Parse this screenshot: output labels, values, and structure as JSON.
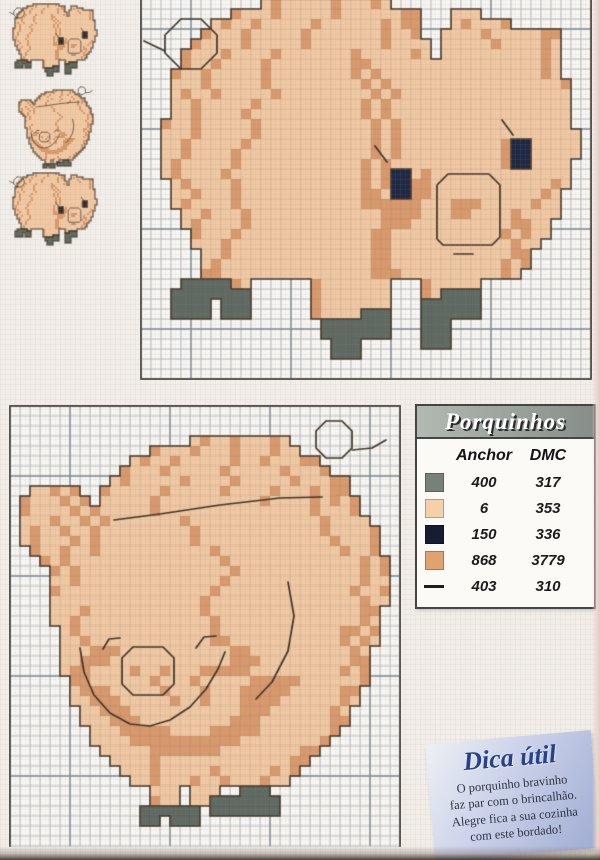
{
  "palette": {
    "l": "#f0c8a3",
    "d": "#d8996c",
    "g": "#5f6a62",
    "n": "#1f2945",
    "outline": "#46392c",
    "backstitch": "#3e342a",
    "grid_thin": "#b7c1c9",
    "grid_bold": "#8494a0",
    "grid_over": "rgba(90,80,70,0.16)",
    "cell_bg": "#f7f5f1",
    "border": "#56524c"
  },
  "legend": {
    "title": "Porquinhos",
    "columns": [
      "Anchor",
      "DMC"
    ],
    "rows": [
      {
        "symbol": "swatch",
        "color": "#76817a",
        "anchor": "400",
        "dmc": "317"
      },
      {
        "symbol": "swatch",
        "color": "#f6d0ab",
        "anchor": "6",
        "dmc": "353"
      },
      {
        "symbol": "swatch",
        "color": "#161d33",
        "anchor": "150",
        "dmc": "336"
      },
      {
        "symbol": "swatch",
        "color": "#e0a26f",
        "anchor": "868",
        "dmc": "3779"
      },
      {
        "symbol": "line",
        "color": "#1d1d1d",
        "anchor": "403",
        "dmc": "310"
      }
    ]
  },
  "tip_box": {
    "title": "Dica útil",
    "lines": [
      "O porquinho bravinho",
      "faz par com o brincalhão.",
      "Alegre fica a sua cozinha",
      "com este bordado!"
    ]
  },
  "charts": {
    "side_pig": {
      "cols": 45,
      "rows": 38,
      "bold_col_offset": 5,
      "bold_row_offset": 3,
      "borders": "LRB",
      "grid": [
        "............ldllllldllldl",
        ".........dllldllllldlllllldd...lll",
        ".......ldlldllllldlllllldldd...ldllld",
        "......dllldllllldllllllldlld..lllldllllldd",
        ".....dlllldllllldllllllldllll.llllldlllldl",
        "....dllldlllldllllllldllllldl.lllllllllldl",
        "....dlldlllldllllllllddllllllllllllllllldl",
        "...dlldllllldlllllllldldlllllllllllllllldl",
        "...llldllllldllllllllldldllllllllllllllllld",
        "...ldlldllllldllllllllldldlllllllllllllllll",
        "...lldllllldlllllllllldldllllllllllllllllll",
        "...lldlllldllllllllllldldllllllllllllllllll",
        "..dlldllllldllllllllllldldlllllllllllllllll",
        "..llldllllldllllllllllldldllllllllllllllllll",
        "..lldllllldlllllllllllldldlllllllllldnnlllll",
        "..lldlllldllllllllllllldldlllllllllldnnlllll",
        "..ldllllldlllllllllllldldllllllllllldnnllll",
        "..ldlllldllllllllllllldldnnldllllllllllllll",
        "...ldlllldlllllllllllldldnnddlllllllllllldl",
        "...lldllldllllllllllllddlnnddllllllllllldl",
        "...ldlllldllllllllllllddddddllldddllllldll",
        "....lldllldlllllllllllllddddlllddlllldllll",
        "....ldlllldllllllllllllldddllllllllllddll",
        ".....dllldlllllllllllllddllllllllllldldll",
        ".....llldllllllllllllllddlllllllllllldll",
        "......lldllllllllllllllddlllllllllllldd",
        "......ldlllllllllllllllddllllllllllldld",
        "......ddllllllllllllllldddlllllllllldl",
        "....gggggdl......dlllllll...dlllll",
        "...gggggggg......dlllllll...dlgggg",
        "...gggg.ggg......dlllllll...gggggg",
        "...gggg.ggg......dllllggg...gggggg",
        "..................ggggggg...ggg",
        "..................ggggggg...ggg",
        "...................ggg......ggg",
        "...................ggg",
        "",
        ""
      ],
      "backstitch": [
        [
          [
            4,
            2
          ],
          [
            6,
            2
          ],
          [
            7.6,
            3.6
          ],
          [
            7.6,
            5.4
          ],
          [
            6,
            7
          ],
          [
            4,
            7
          ],
          [
            2.4,
            5.4
          ],
          [
            2.4,
            3.6
          ],
          [
            4,
            2
          ]
        ],
        [
          [
            0.3,
            4.2
          ],
          [
            2.4,
            5.2
          ]
        ],
        [
          [
            30.2,
            24.6
          ],
          [
            29.6,
            24
          ],
          [
            29.6,
            18.6
          ],
          [
            30.7,
            17.5
          ],
          [
            34.8,
            17.5
          ],
          [
            35.9,
            18.6
          ],
          [
            35.9,
            23.8
          ],
          [
            35.1,
            24.6
          ],
          [
            30.2,
            24.6
          ]
        ],
        [
          [
            31.3,
            25.5
          ],
          [
            33.2,
            25.5
          ]
        ],
        [
          [
            24.6,
            16.3
          ],
          [
            23.4,
            14.7
          ]
        ],
        [
          [
            37.2,
            13.6
          ],
          [
            36.1,
            12.1
          ]
        ]
      ]
    },
    "face_pig": {
      "cols": 39,
      "rows": 44,
      "bold_col_offset": 6,
      "bold_row_offset": 7,
      "borders": "LTR",
      "grid": [
        "",
        "",
        "",
        "..................ldlldllldl",
        "..............dllldllldllldll",
        "............ldlldllllldlldllldd",
        "...........dllldllllldllllldllld",
        "..........ldllllldlllldllllldllldd",
        "..lldld..dllllldllllldlllldllldldd",
        ".dllldld.llllldlllllllllldlllldldld",
        ".dlllldldllllldllllllllllllllldllld",
        ".llldlldldllllllldllllllllllllldllll",
        ".ldlldlldllllllllldlllllllllllldlllld",
        ".ldllldldllllllllldllllllllllllldllld",
        "..dlldlldllllllllllldlllllllllllldlld",
        "...dldllllllllllllllldllllllllllllldld",
        "....dldllllllllllllllldlllllllllllldld",
        "....lldlllllllllllllldllllllllllllldll",
        "....dllllllllllllllldllllllllllllldlld",
        "....llllllllllllllldllllllllllllllldll",
        "....llldllllllllllldllllllllllllllldd",
        "....lldllllllllllllldlllllllllllllldl",
        ".....ldllllllllllllldllllllllllllddld",
        ".....lldllllllllllllddllllllllllldldl",
        ".....llldddlllllllllllddlllllllllldl",
        ".....lldddlllllllllllldddllllllllldd",
        ".....lddlllldlldllldddddllllllllldld",
        "......ddlllllldllldllllldddddlllllld",
        "......ldddllllldllldllldddddllllldd",
        "......lldddllllldlldlllddddlllllldl",
        ".......lldddllllllllllldddlllllldl",
        ".......llldddllllllllldddllllllldd",
        "........llldddddlllldddddllllllld",
        "........lllldddddddddddlllllllld",
        ".........llllldddddddlllllllldd",
        "..........lllldllllllllllllldd",
        "...........llldllllldllllldld",
        "............lldllldlldllldll",
        "..............lll.lll..ggg",
        "..............dll.llggggggg",
        ".............gggggg.ggggggg",
        ".............gg.ggg",
        "",
        ""
      ],
      "backstitch": [
        [
          [
            31.6,
            1.5
          ],
          [
            33.2,
            1.5
          ],
          [
            34.2,
            2.5
          ],
          [
            34.2,
            4.2
          ],
          [
            33.2,
            5.2
          ],
          [
            31.6,
            5.2
          ],
          [
            30.6,
            4.2
          ],
          [
            30.6,
            2.5
          ],
          [
            31.6,
            1.5
          ]
        ],
        [
          [
            34.2,
            4.4
          ],
          [
            36.2,
            4.2
          ],
          [
            37.6,
            3.4
          ]
        ],
        [
          [
            10.4,
            11.4
          ],
          [
            15,
            10.8
          ],
          [
            21,
            9.9
          ],
          [
            27,
            9.2
          ],
          [
            31.2,
            9.1
          ]
        ],
        [
          [
            27.8,
            17.6
          ],
          [
            28.4,
            21
          ],
          [
            27.8,
            24.5
          ],
          [
            26.2,
            27.6
          ],
          [
            24.6,
            29.3
          ]
        ],
        [
          [
            12.3,
            24.1
          ],
          [
            15.3,
            24.1
          ],
          [
            16.4,
            25.2
          ],
          [
            16.4,
            27.8
          ],
          [
            15.3,
            28.9
          ],
          [
            12.3,
            28.9
          ],
          [
            11.2,
            27.8
          ],
          [
            11.2,
            25.2
          ],
          [
            12.3,
            24.1
          ]
        ],
        [
          [
            7.0,
            24.2
          ],
          [
            7.4,
            26.6
          ],
          [
            8.4,
            28.9
          ],
          [
            10,
            30.7
          ],
          [
            12,
            31.8
          ],
          [
            14,
            32
          ],
          [
            16,
            31.4
          ],
          [
            18,
            30.1
          ],
          [
            19.6,
            28.3
          ],
          [
            20.8,
            26.3
          ],
          [
            21.5,
            24.6
          ]
        ],
        [
          [
            9.3,
            24.3
          ],
          [
            9.9,
            23.3
          ],
          [
            11.0,
            23.2
          ]
        ],
        [
          [
            18.6,
            24.2
          ],
          [
            19.4,
            23.1
          ],
          [
            20.6,
            23.0
          ]
        ]
      ]
    }
  }
}
